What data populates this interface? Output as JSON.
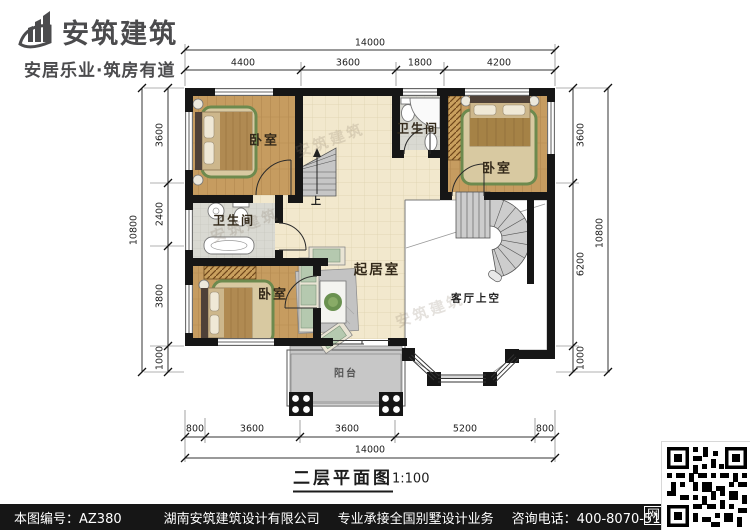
{
  "brand": {
    "name": "安筑建筑",
    "tagline": "安居乐业·筑房有道"
  },
  "plan": {
    "title": "二层平面图",
    "scale": "1:100",
    "labels": {
      "bedroom": "卧室",
      "bathroom": "卫生间",
      "living": "起居室",
      "void_above_living": "客厅上空",
      "balcony": "阳台",
      "stairs_up": "上"
    },
    "watermark": "安筑建筑"
  },
  "dimensions": {
    "top": {
      "overall": "14000",
      "segments": [
        "4400",
        "3600",
        "1800",
        "4200"
      ]
    },
    "bottom": {
      "overall": "14000",
      "segments": [
        "800",
        "3600",
        "3600",
        "5200",
        "800"
      ]
    },
    "left": {
      "overall": "10800",
      "segments": [
        "3600",
        "2400",
        "3800",
        "1000"
      ]
    },
    "right": {
      "overall": "10800",
      "segments": [
        "3600",
        "6200",
        "1000"
      ]
    }
  },
  "footer": {
    "serial": "本图编号：AZ380",
    "company": "湖南安筑建筑设计有限公司",
    "business": "专业承接全国别墅设计业务",
    "phone": "咨询电话：400-8070-511",
    "web": "网"
  },
  "colors": {
    "wall": "#161616",
    "wood_floor": "#c69c60",
    "tile_floor": "#f2e8cd",
    "bath_floor": "#d9d9d2",
    "rug_border": "#6d8a4e",
    "footer_bar": "#161616"
  }
}
